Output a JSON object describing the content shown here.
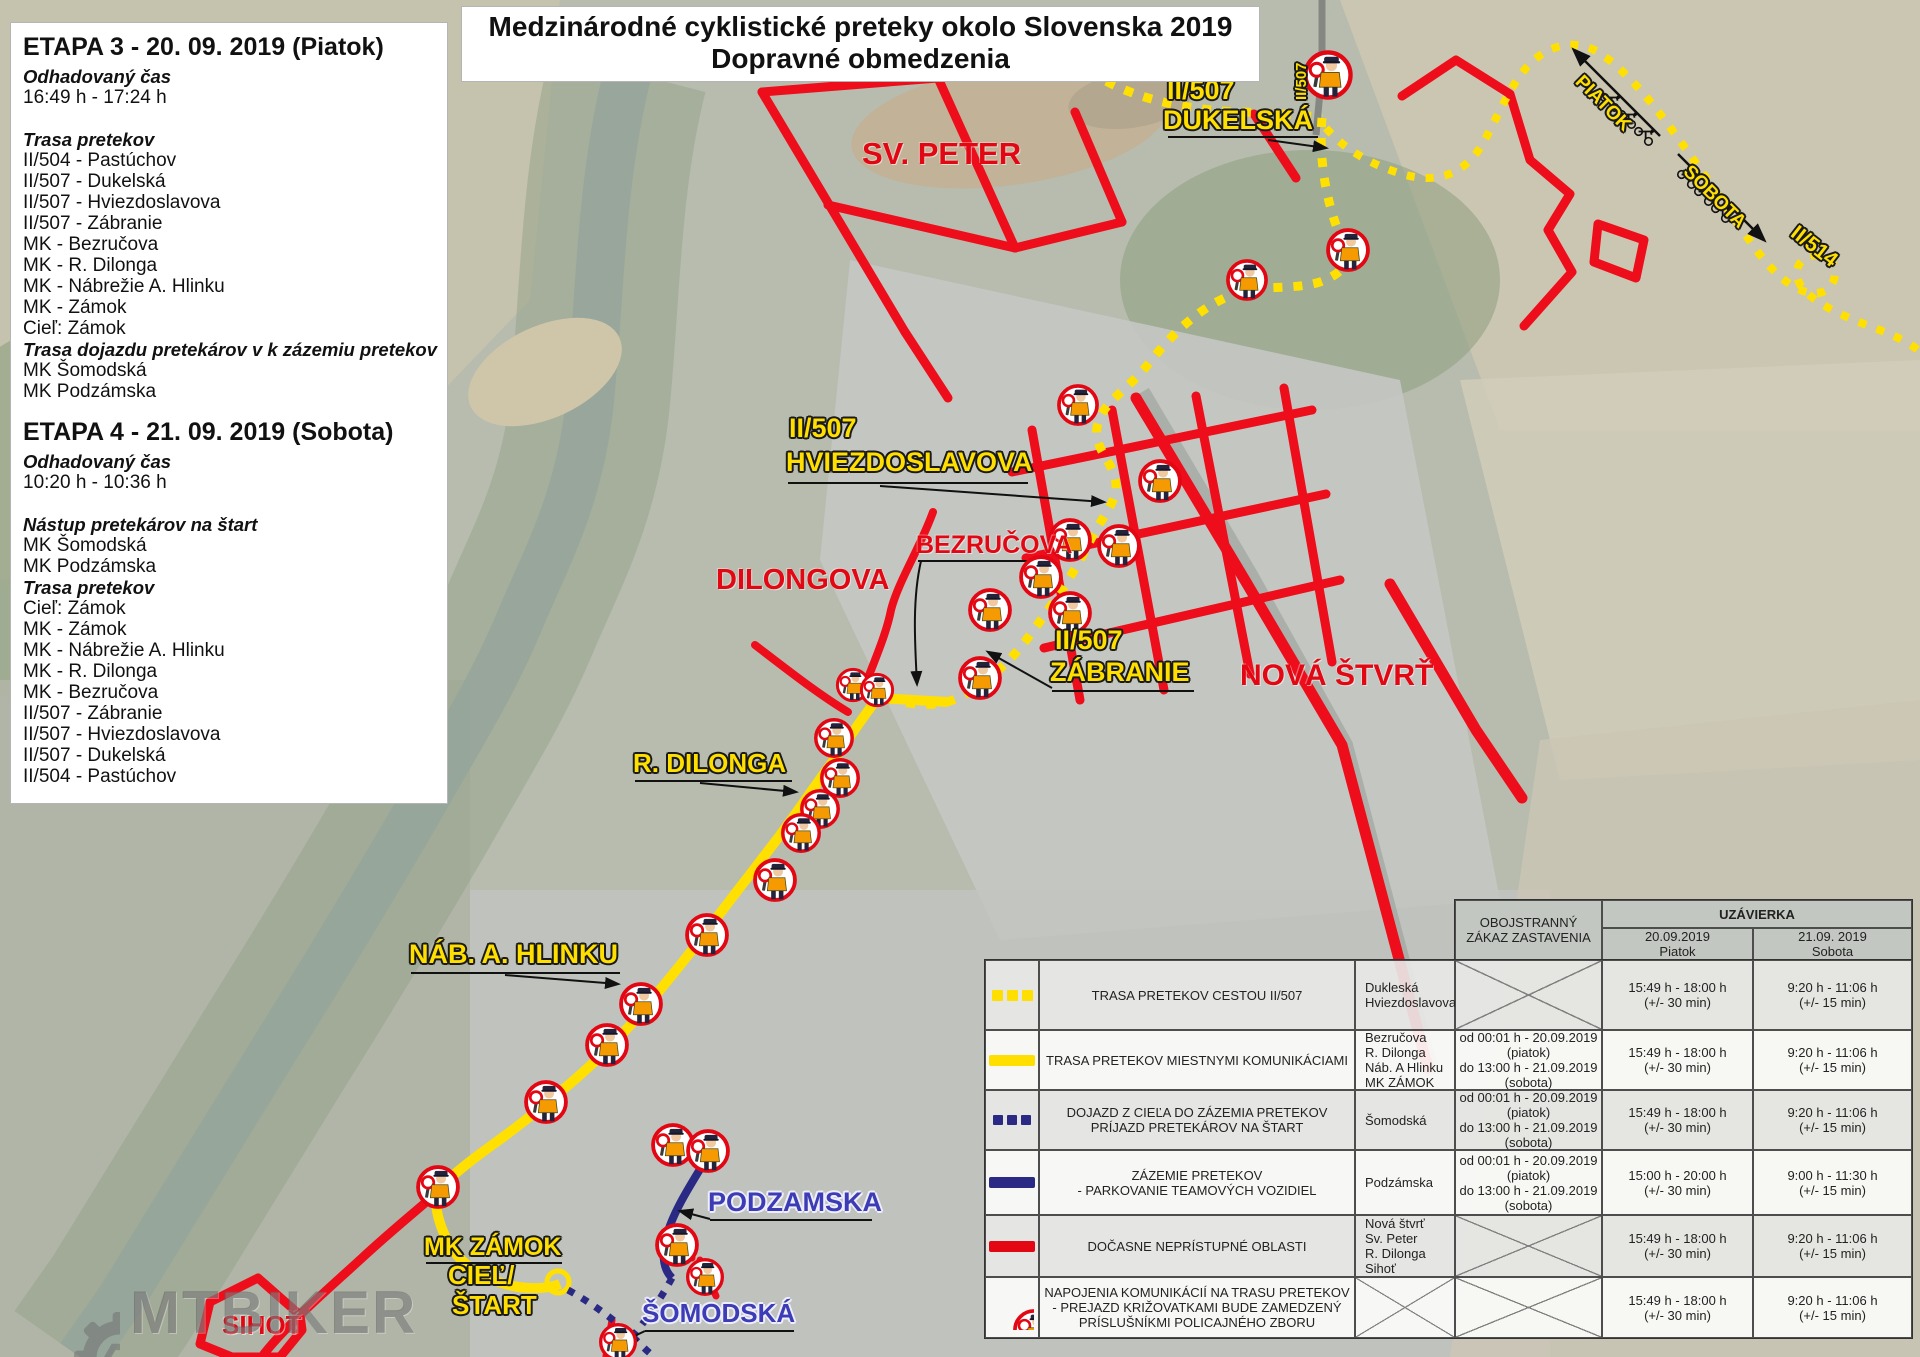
{
  "title": {
    "line1": "Medzinárodné cyklistické preteky okolo Slovenska 2019",
    "line2": "Dopravné obmedzenia"
  },
  "etapa3": {
    "heading": "ETAPA 3 - 20. 09. 2019 (Piatok)",
    "lines": [
      {
        "text": "Odhadovaný čas",
        "style": "bi"
      },
      {
        "text": "16:49 h - 17:24 h",
        "style": ""
      },
      {
        "text": "",
        "style": "sp"
      },
      {
        "text": "Trasa pretekov",
        "style": "bi"
      },
      {
        "text": "II/504 - Pastúchov",
        "style": ""
      },
      {
        "text": "II/507 - Dukelská",
        "style": ""
      },
      {
        "text": "II/507 - Hviezdoslavova",
        "style": ""
      },
      {
        "text": "II/507 - Zábranie",
        "style": ""
      },
      {
        "text": "MK - Bezručova",
        "style": ""
      },
      {
        "text": "MK - R. Dilonga",
        "style": ""
      },
      {
        "text": "MK - Nábrežie A. Hlinku",
        "style": ""
      },
      {
        "text": "MK - Zámok",
        "style": ""
      },
      {
        "text": "Cieľ: Zámok",
        "style": ""
      },
      {
        "text": "Trasa dojazdu pretekárov v k zázemiu pretekov",
        "style": "bi"
      },
      {
        "text": "MK Šomodská",
        "style": ""
      },
      {
        "text": "MK Podzámska",
        "style": ""
      }
    ]
  },
  "etapa4": {
    "heading": "ETAPA 4 - 21. 09. 2019 (Sobota)",
    "lines": [
      {
        "text": "Odhadovaný čas",
        "style": "bi"
      },
      {
        "text": "10:20 h - 10:36 h",
        "style": ""
      },
      {
        "text": "",
        "style": "sp"
      },
      {
        "text": "Nástup pretekárov na štart",
        "style": "bi"
      },
      {
        "text": "MK Šomodská",
        "style": ""
      },
      {
        "text": "MK Podzámska",
        "style": ""
      },
      {
        "text": "Trasa pretekov",
        "style": "bi"
      },
      {
        "text": "Cieľ: Zámok",
        "style": ""
      },
      {
        "text": "MK - Zámok",
        "style": ""
      },
      {
        "text": "MK - Nábrežie A. Hlinku",
        "style": ""
      },
      {
        "text": "MK - R. Dilonga",
        "style": ""
      },
      {
        "text": "MK - Bezručova",
        "style": ""
      },
      {
        "text": "II/507 - Zábranie",
        "style": ""
      },
      {
        "text": "II/507 - Hviezdoslavova",
        "style": ""
      },
      {
        "text": "II/507 - Dukelská",
        "style": ""
      },
      {
        "text": "II/504 - Pastúchov",
        "style": ""
      }
    ]
  },
  "labels": {
    "sv_peter": "SV. PETER",
    "dukelska_road": "II/507",
    "dukelska": "DUKELSKÁ",
    "road_507_vertical": "II/507",
    "piatok": "PIATOK",
    "sobota": "SOBOTA",
    "ii514": "II/514",
    "hviezdoslavova_road": "II/507",
    "hviezdoslavova": "HVIEZDOSLAVOVA",
    "bezrucova": "BEZRUČOVA",
    "dilongova": "DILONGOVA",
    "zabranie_road": "II/507",
    "zabranie": "ZÁBRANIE",
    "nova_stvrt": "NOVÁ ŠTVRŤ",
    "r_dilonga": "R. DILONGA",
    "nab_a_hlinku": "NÁB. A. HLINKU",
    "podzamska": "PODZAMSKA",
    "mk_zamok": "MK ZÁMOK",
    "ciel_line1": "CIEĽ/",
    "ciel_line2": "ŠTART",
    "somodska": "ŠOMODSKÁ",
    "sihot": "SIHOŤ"
  },
  "legend": {
    "header": {
      "obojstranny": "OBOJSTRANNÝ\nZÁKAZ ZASTAVENIA",
      "uzavierka": "UZÁVIERKA",
      "col_piatok": "20.09.2019\nPiatok",
      "col_sobota": "21.09. 2019\nSobota"
    },
    "rows": [
      {
        "symbol": "yellow-dotted",
        "desc": "TRASA PRETEKOV CESTOU II/507",
        "streets": "Dukleská\nHviezdoslavova",
        "zakaz": "X",
        "piatok": "15:49 h - 18:00 h\n(+/- 30 min)",
        "sobota": "9:20 h - 11:06 h\n(+/- 15 min)"
      },
      {
        "symbol": "yellow-solid",
        "desc": "TRASA PRETEKOV MIESTNYMI KOMUNIKÁCIAMI",
        "streets": "Bezručova\nR. Dilonga\nNáb. A Hlinku\nMK ZÁMOK",
        "zakaz": "od 00:01 h - 20.09.2019\n(piatok)\ndo 13:00 h - 21.09.2019\n(sobota)",
        "piatok": "15:49 h - 18:00 h\n(+/- 30 min)",
        "sobota": "9:20 h - 11:06 h\n(+/- 15 min)"
      },
      {
        "symbol": "navy-dotted",
        "desc": "DOJAZD Z CIEĽA DO ZÁZEMIA PRETEKOV\nPRÍJAZD PRETEKÁROV NA ŠTART",
        "streets": "Šomodská",
        "zakaz": "od 00:01 h - 20.09.2019\n(piatok)\ndo 13:00 h - 21.09.2019\n(sobota)",
        "piatok": "15:49 h - 18:00 h\n(+/- 30 min)",
        "sobota": "9:20 h - 11:06 h\n(+/- 15 min)"
      },
      {
        "symbol": "navy-solid",
        "desc": "ZÁZEMIE PRETEKOV\n- PARKOVANIE TEAMOVÝCH VOZIDIEL",
        "streets": "Podzámska",
        "zakaz": "od 00:01 h - 20.09.2019\n(piatok)\ndo 13:00 h - 21.09.2019\n(sobota)",
        "piatok": "15:00 h - 20:00 h\n(+/- 30 min)",
        "sobota": "9:00 h - 11:30 h\n(+/- 15 min)"
      },
      {
        "symbol": "red-solid",
        "desc": "DOČASNE NEPRÍSTUPNÉ OBLASTI",
        "streets": "Nová štvrť\nSv. Peter\nR. Dilonga\nSihoť",
        "zakaz": "X",
        "piatok": "15:49 h - 18:00 h\n(+/- 30 min)",
        "sobota": "9:20 h - 11:06 h\n(+/- 15 min)"
      },
      {
        "symbol": "police",
        "desc": "NAPOJENIA KOMUNIKÁCIÍ NA TRASU PRETEKOV\n- PREJAZD KRIŽOVATKAMI BUDE ZAMEDZENÝ\nPRÍSLUŠNÍKMI POLICAJNÉHO ZBORU",
        "streets": "X",
        "zakaz": "X",
        "piatok": "15:49 h - 18:00 h\n(+/- 30 min)",
        "sobota": "9:20 h - 11:06 h\n(+/- 15 min)"
      }
    ]
  },
  "watermark": {
    "text": "MTBIKER"
  },
  "colors": {
    "route_yellow": "#ffdf00",
    "closed_red": "#e30613",
    "zazemie_navy": "#2a2a85",
    "blue_label": "#3c3cb4"
  }
}
